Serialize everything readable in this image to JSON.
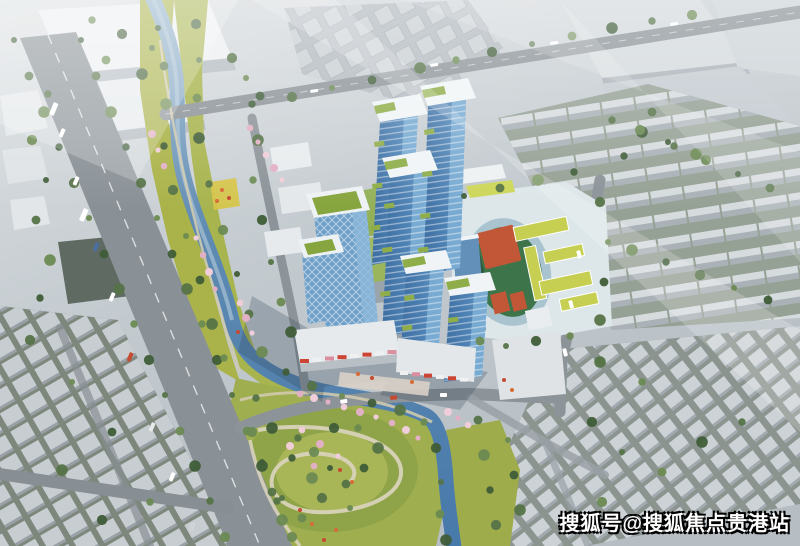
{
  "image": {
    "kind": "aerial-architectural-rendering",
    "subject": "riverside high-rise development with retail podium, riverside park, school campus and surrounding low-rise city blocks"
  },
  "watermark": {
    "text": "搜狐号@搜狐焦点贵港站"
  },
  "scene": {
    "landmarks": [
      {
        "id": "residential-towers",
        "label": "blue glass residential towers with white caps and sky gardens"
      },
      {
        "id": "office-towers",
        "label": "lattice-facade office towers with green roofs"
      },
      {
        "id": "retail-podium",
        "label": "commercial podium with red storefront signs"
      },
      {
        "id": "school-campus",
        "label": "school with running track, red courts and yellow-green roofed buildings"
      },
      {
        "id": "river",
        "label": "winding river with landscaped yellow-green banks"
      },
      {
        "id": "central-park",
        "label": "park mound with looping paths, dense trees and pink blossoms"
      },
      {
        "id": "main-avenue",
        "label": "tree-lined avenue with vehicles"
      },
      {
        "id": "bridge-road",
        "label": "road crossing the river on a bridge toward the northeast"
      },
      {
        "id": "old-town-southwest",
        "label": "dense grid of small gray flat-roofed buildings"
      },
      {
        "id": "old-town-southeast",
        "label": "dense grid of small gray flat-roofed buildings"
      },
      {
        "id": "row-housing-east",
        "label": "rows of gray gabled buildings with tree lines"
      },
      {
        "id": "industrial-northwest",
        "label": "large white flat-roofed industrial buildings"
      },
      {
        "id": "light-glare",
        "label": "diagonal white light glare across upper image"
      }
    ]
  },
  "colors": {
    "river_water": "#4779aa",
    "park_green": "#a8b44e",
    "tree_green": "#3f5d38",
    "tower_glass": "#3e6ea2",
    "tower_glass_light": "#7fb0d6",
    "roof_garden": "#8fae4a",
    "track_surface": "#c25738",
    "track_ring": "#a9c4ce",
    "school_roof": "#c6cf52",
    "road_gray": "#8a9196",
    "context_building": "#c8cdd1",
    "blossom_pink": "#e2b0c4",
    "accent_red": "#c64a30",
    "watermark_text": "#ffffff",
    "watermark_outline": "#000000"
  }
}
